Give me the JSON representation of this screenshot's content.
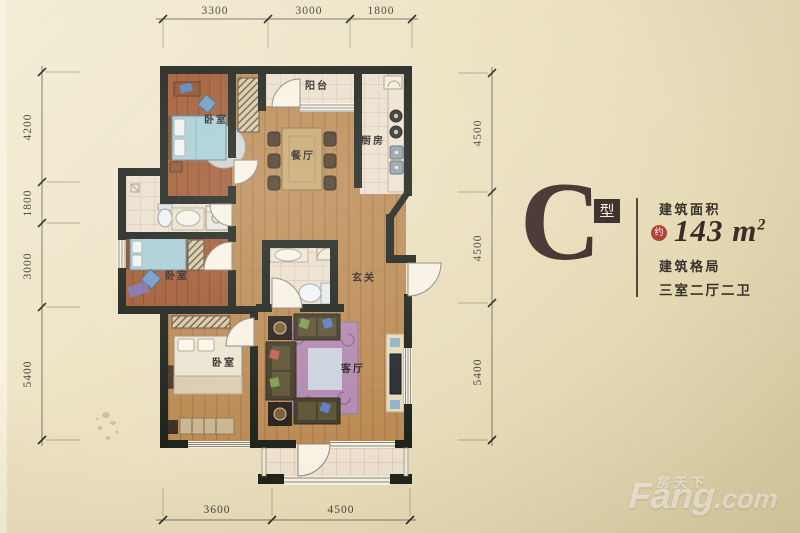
{
  "plan": {
    "rooms": {
      "bedroom_top": "卧室",
      "balcony_top": "阳台",
      "dining": "餐厅",
      "kitchen": "厨房",
      "bedroom_mid": "卧室",
      "entry": "玄关",
      "bedroom_bottom": "卧室",
      "living": "客厅"
    },
    "dims": {
      "top": [
        "3300",
        "3000",
        "1800"
      ],
      "left": [
        "4200",
        "1800",
        "3000",
        "5400"
      ],
      "right": [
        "4500",
        "4500",
        "5400"
      ],
      "bottom": [
        "3600",
        "4500"
      ]
    }
  },
  "panel": {
    "type_letter": "C",
    "type_badge": "型",
    "area_label": "建筑面积",
    "approx_badge": "约",
    "area_value": "143",
    "area_unit": "m",
    "area_sup": "2",
    "layout_label": "建筑格局",
    "layout_value": "三室二厅二卫"
  },
  "watermark": {
    "cn": "房天下",
    "latin": "Fang",
    "tld": ".com"
  },
  "colors": {
    "wall": "#1f231d",
    "wood_light": "#bc8b54",
    "wood_red": "#a25b35",
    "tile": "#ece0ce",
    "bed_blue": "#a9ced6",
    "rug_purple": "#b28ab0",
    "accent_red": "#b5403a",
    "ink_maroon": "#3f2d2c",
    "background": "#e9dfbe"
  }
}
